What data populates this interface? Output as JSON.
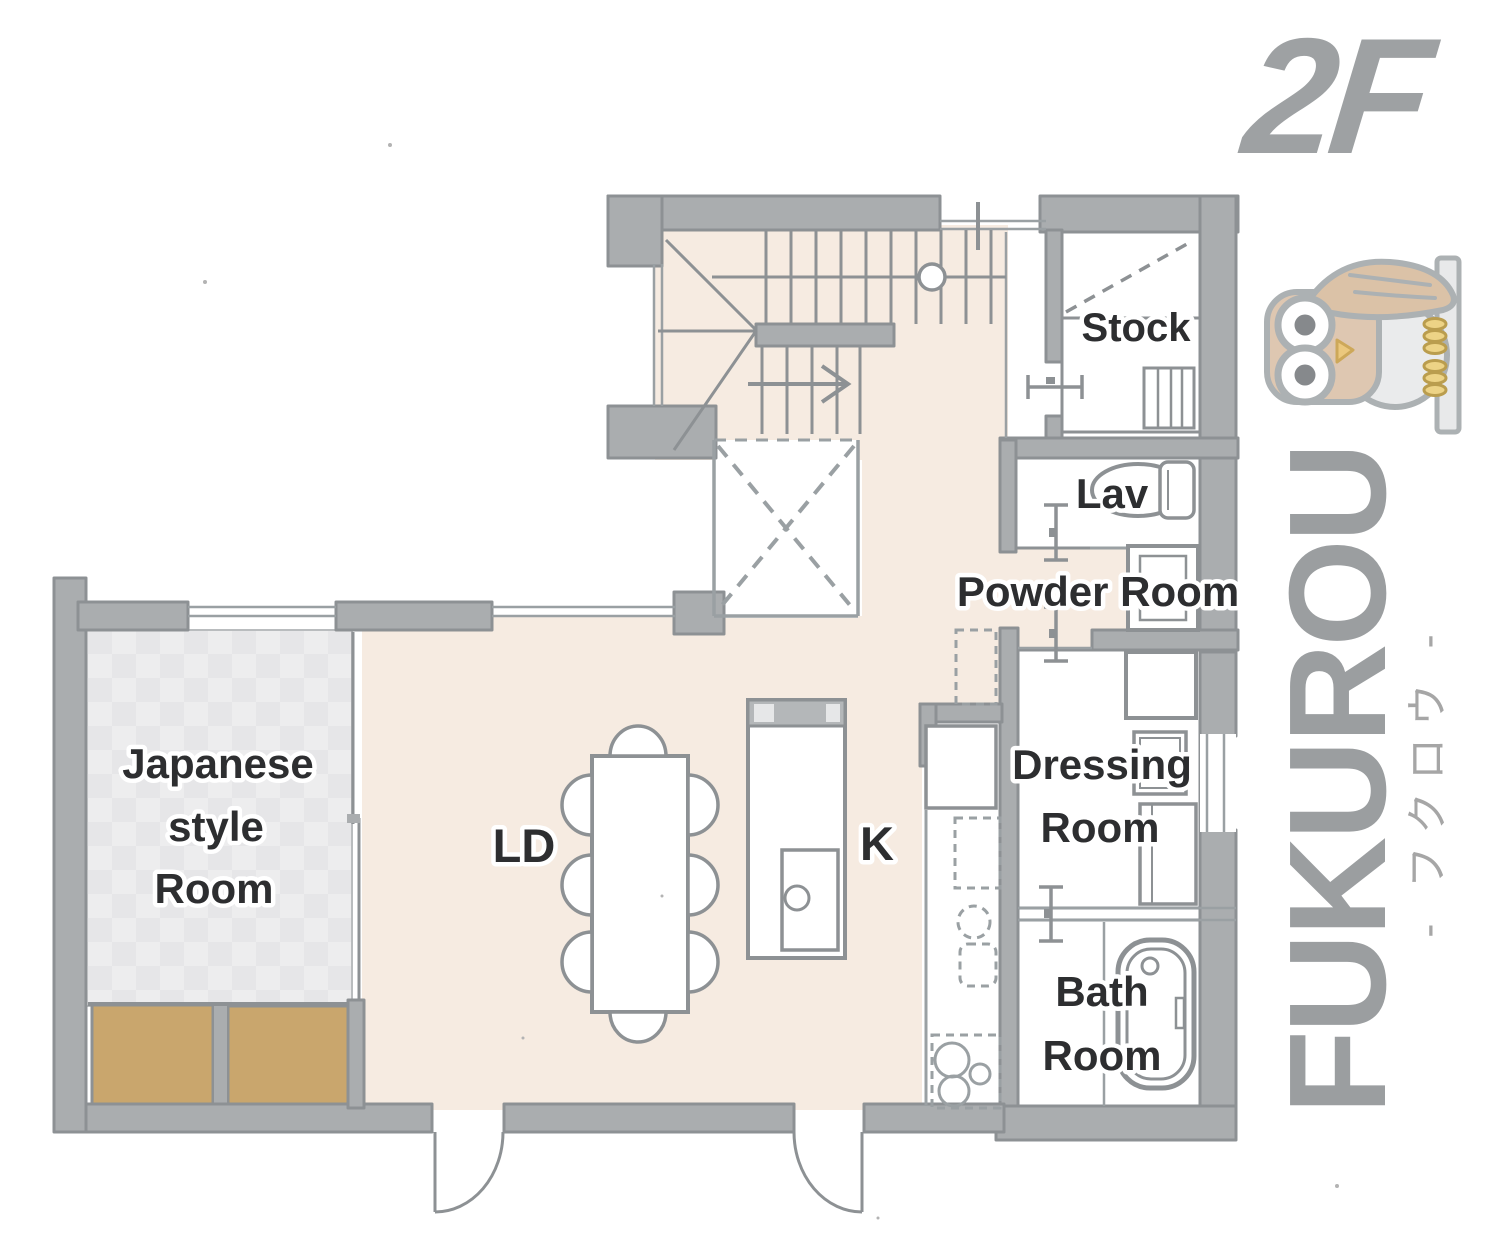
{
  "branding": {
    "floor_label": "2F",
    "house_name": "FUKUROU",
    "house_name_kana": "- フクロウ -",
    "logo_icon": "owl-on-pole-icon"
  },
  "rooms": {
    "stock": {
      "label": "Stock"
    },
    "lav": {
      "label": "Lav"
    },
    "powder": {
      "label": "Powder Room"
    },
    "dressing": {
      "line1": "Dressing",
      "line2": "Room"
    },
    "bath": {
      "line1": "Bath",
      "line2": "Room"
    },
    "japanese": {
      "line1": "Japanese",
      "line2": "style",
      "line3": "Room"
    },
    "living_dining": {
      "label": "LD"
    },
    "kitchen": {
      "label": "K"
    }
  },
  "colors": {
    "floor_beige": "#f6ebe1",
    "wall_fill": "#aaadaf",
    "wall_outline": "#8d9194",
    "room_white": "#ffffff",
    "tatami_light": "#ededee",
    "tatami_dark": "#e6e6e8",
    "closet_tan": "#c9a66d",
    "label_text": "#2d2e30",
    "brand_gray": "#9ea1a3",
    "owl_tan": "#dcc3ab",
    "owl_claw_yellow": "#ecd07c"
  }
}
